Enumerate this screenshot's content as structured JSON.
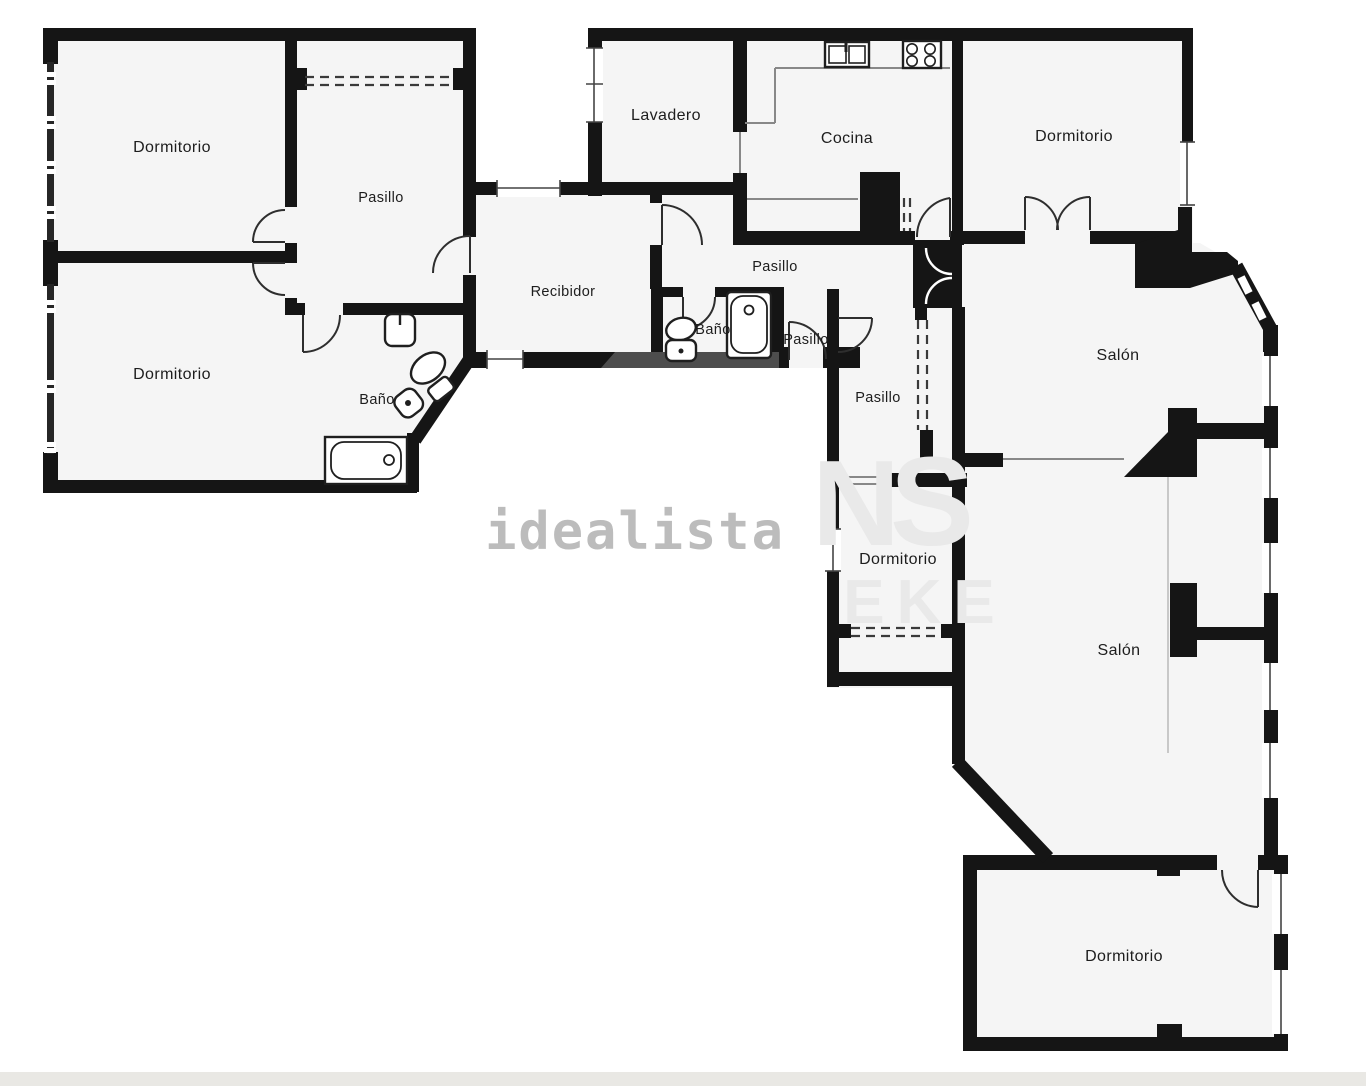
{
  "image": {
    "width": 1366,
    "height": 1086,
    "background_color": "#ffffff",
    "bottom_bar_color": "#e9e8e4"
  },
  "floorplan": {
    "wall_color": "#151515",
    "room_fill_color": "#f5f5f5",
    "landing_color": "#4d4d4d",
    "rooms": [
      {
        "id": "dormitorio-top-left",
        "label": "Dormitorio"
      },
      {
        "id": "pasillo-top-left",
        "label": "Pasillo"
      },
      {
        "id": "dormitorio-mid-left",
        "label": "Dormitorio"
      },
      {
        "id": "bano-left",
        "label": "Baño"
      },
      {
        "id": "recibidor",
        "label": "Recibidor"
      },
      {
        "id": "lavadero",
        "label": "Lavadero"
      },
      {
        "id": "cocina",
        "label": "Cocina"
      },
      {
        "id": "pasillo-central",
        "label": "Pasillo"
      },
      {
        "id": "bano-central",
        "label": "Baño"
      },
      {
        "id": "pasillo-entrada",
        "label": "Pasillo"
      },
      {
        "id": "pasillo-vertical",
        "label": "Pasillo"
      },
      {
        "id": "dormitorio-top-right",
        "label": "Dormitorio"
      },
      {
        "id": "salon-superior",
        "label": "Salón"
      },
      {
        "id": "dormitorio-central",
        "label": "Dormitorio"
      },
      {
        "id": "salon-inferior",
        "label": "Salón"
      },
      {
        "id": "dormitorio-bottom-right",
        "label": "Dormitorio"
      }
    ],
    "fixtures": [
      "bathtub-icon",
      "toilet-icon",
      "washbasin-icon",
      "bidet-icon",
      "bathtub-2-icon",
      "toilet-2-icon",
      "kitchen-sink-icon",
      "stove-icon"
    ]
  },
  "watermarks": {
    "primary": "idealista",
    "letter_n": "N",
    "letter_s": "S",
    "letter_eke": "EKE"
  }
}
